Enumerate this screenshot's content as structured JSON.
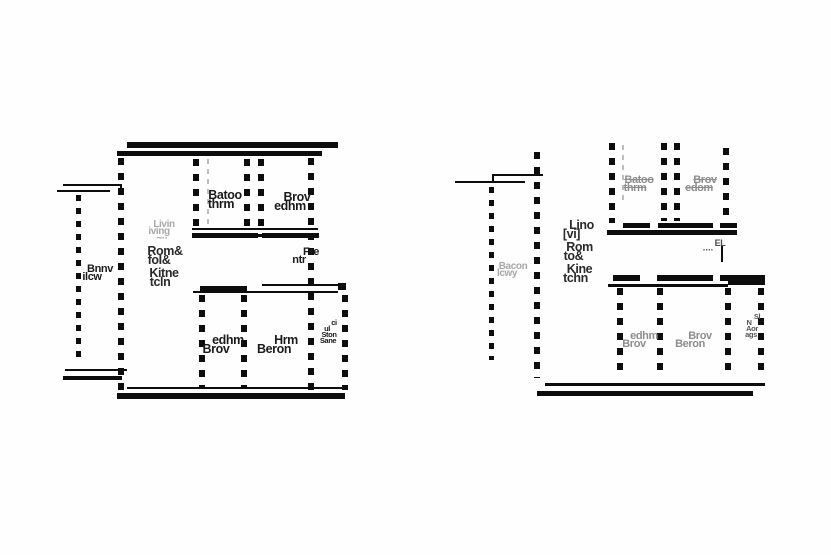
{
  "colors": {
    "wall": "#0d0d0d",
    "label_dark": "#1b1b1b",
    "label_gray": "#8d8d8d",
    "label_faint": "#a8a8a8",
    "background": "#fefefe"
  },
  "left": {
    "bathroom": [
      "Batoo",
      "thrm"
    ],
    "bedroom_top": [
      "Brov",
      "edhm"
    ],
    "living_faint": [
      "Livin",
      "iving",
      "~··"
    ],
    "living_mid": [
      "Rom&",
      "foI&"
    ],
    "living_kitchen": [
      "Kitne",
      "tcln"
    ],
    "balcony": [
      "Bnnv",
      "ilcw"
    ],
    "entry": [
      "Fre",
      "ntr"
    ],
    "bedroom_bottom_left": [
      "edhm",
      "Brov"
    ],
    "bedroom_bottom_right": [
      "Hrm",
      "Beron"
    ],
    "storage": [
      "ci",
      "ul",
      "Ston",
      "Sane"
    ]
  },
  "right": {
    "bathroom": [
      "Batoo",
      "thrm"
    ],
    "bedroom_top": [
      "Brov",
      "edom"
    ],
    "living_top": [
      "Lino",
      "[vi]"
    ],
    "living_mid": [
      "Rom",
      "to&"
    ],
    "living_kitchen": [
      "Kine",
      "tchn"
    ],
    "balcony": [
      "Bacon",
      "lcwy"
    ],
    "entry": [
      "EL",
      "····"
    ],
    "bedroom_bottom_left": [
      "edhm",
      "Brov"
    ],
    "bedroom_bottom_right": [
      "Brov",
      "Beron"
    ],
    "storage": [
      "Sl",
      "N",
      "Aor",
      "ags"
    ]
  }
}
